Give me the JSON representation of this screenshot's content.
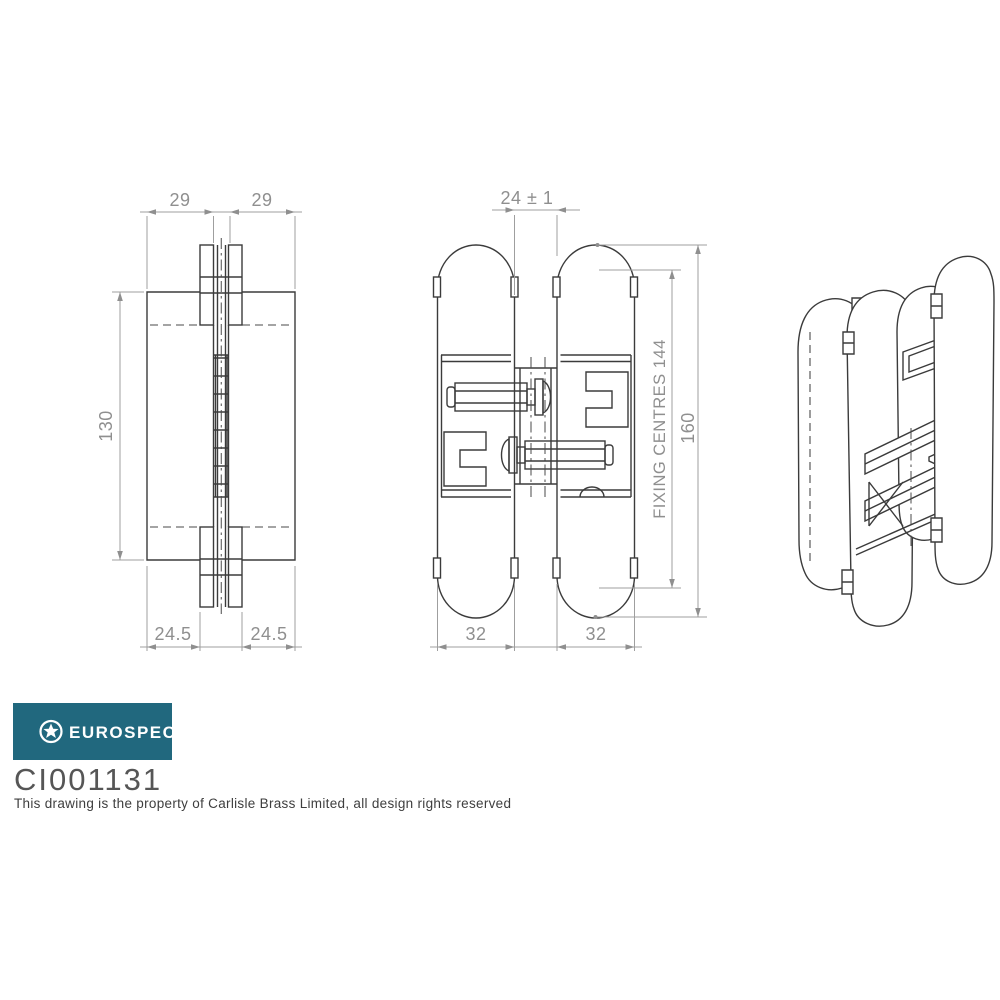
{
  "views": {
    "front": {
      "dim_top_left": "29",
      "dim_top_right": "29",
      "dim_height": "130",
      "dim_bottom_left": "24.5",
      "dim_bottom_right": "24.5"
    },
    "side": {
      "dim_gap": "24 ± 1",
      "dim_fixing_centres": "FIXING CENTRES 144",
      "dim_overall_height": "160",
      "dim_width_left": "32",
      "dim_width_right": "32"
    }
  },
  "footer": {
    "brand": "EUROSPEC",
    "code": "CI001131",
    "copyright": "This drawing is the property of Carlisle Brass Limited, all design rights reserved"
  },
  "colors": {
    "brand_teal": "#21687e",
    "line": "#3b3b3b",
    "dim": "#9a9a9a"
  }
}
